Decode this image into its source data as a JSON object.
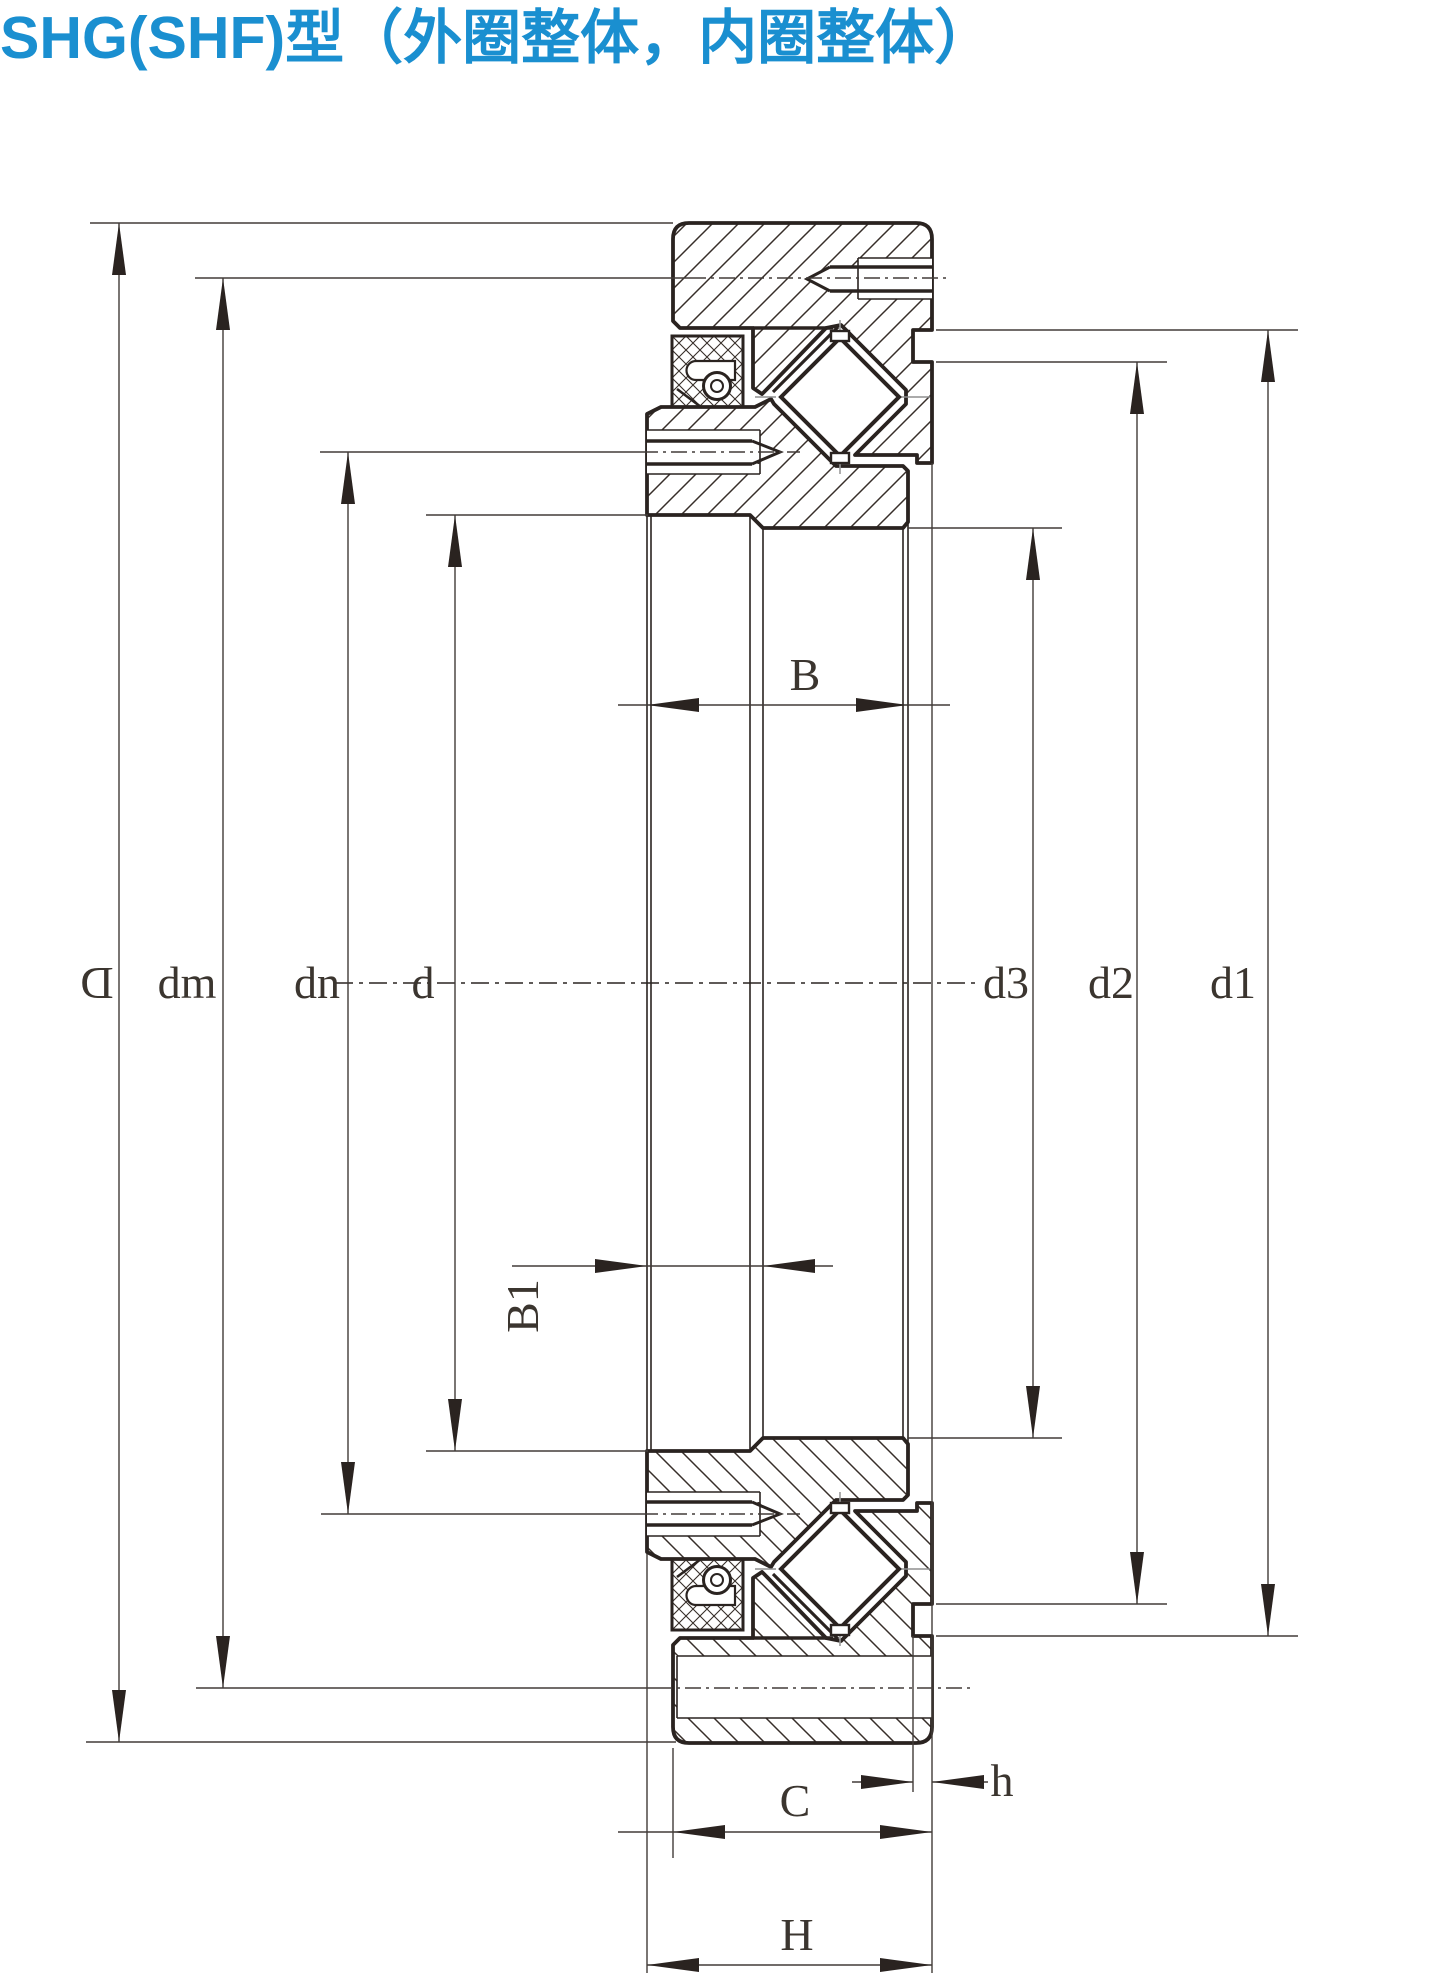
{
  "title": "SHG(SHF)型（外圈整体，内圈整体）",
  "accent_color": "#1a8fd0",
  "line_color": "#2a2320",
  "drawing": {
    "type": "technical-cross-section",
    "subject": "SHG(SHF) crossed roller bearing, outer ring solid, inner ring solid",
    "dimension_labels": {
      "D": "D",
      "dm": "dm",
      "dn": "dn",
      "d": "d",
      "d3": "d3",
      "d2": "d2",
      "d1": "d1",
      "B": "B",
      "B1": "B1",
      "C": "C",
      "h": "h",
      "H": "H"
    }
  }
}
